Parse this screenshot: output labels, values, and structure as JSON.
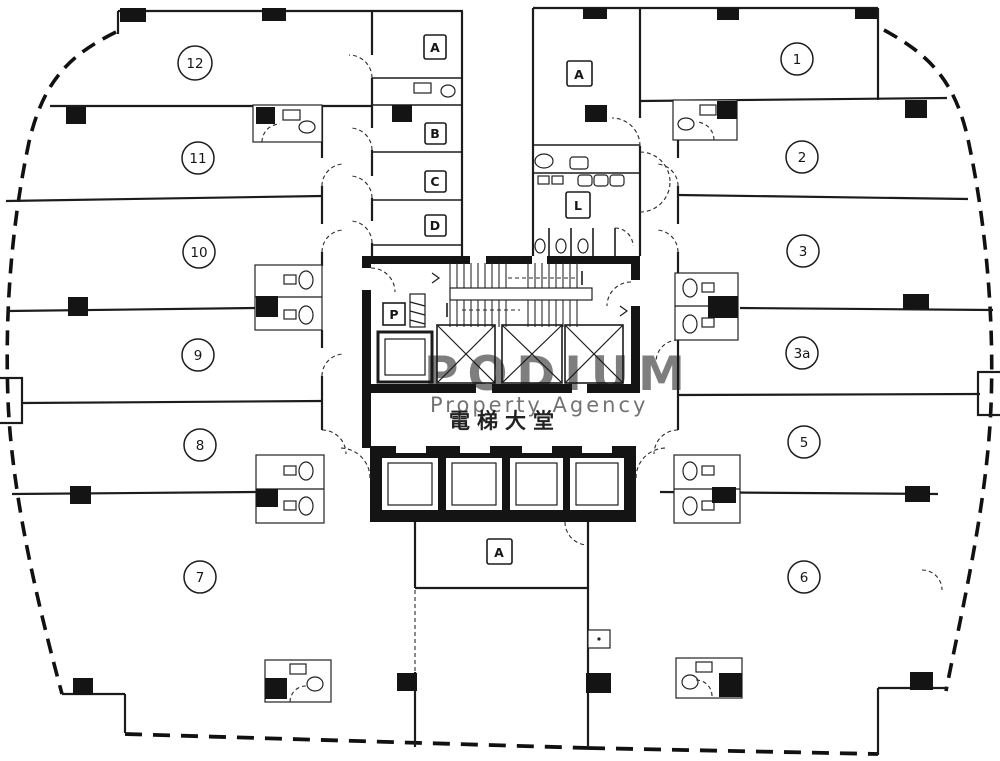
{
  "plan": {
    "lobby_label": "電梯大堂",
    "watermark": {
      "primary": "PODIUM",
      "secondary": "Property Agency"
    },
    "units": [
      {
        "key": "12",
        "label": "12"
      },
      {
        "key": "11",
        "label": "11"
      },
      {
        "key": "10",
        "label": "10"
      },
      {
        "key": "9",
        "label": "9"
      },
      {
        "key": "8",
        "label": "8"
      },
      {
        "key": "7",
        "label": "7"
      },
      {
        "key": "1",
        "label": "1"
      },
      {
        "key": "2",
        "label": "2"
      },
      {
        "key": "3",
        "label": "3"
      },
      {
        "key": "3a",
        "label": "3a"
      },
      {
        "key": "5",
        "label": "5"
      },
      {
        "key": "6",
        "label": "6"
      }
    ],
    "rooms": [
      {
        "key": "a-top-left",
        "label": "A"
      },
      {
        "key": "b",
        "label": "B"
      },
      {
        "key": "c",
        "label": "C"
      },
      {
        "key": "d",
        "label": "D"
      },
      {
        "key": "a-top-right",
        "label": "A"
      },
      {
        "key": "l-lavatory",
        "label": "L"
      },
      {
        "key": "p-pipe-duct",
        "label": "P"
      },
      {
        "key": "a-bottom",
        "label": "A"
      }
    ],
    "colors": {
      "ink": "#1c1c1c",
      "background": "#ffffff",
      "watermark_primary": "#cf8d83",
      "watermark_secondary": "#e9bfb4"
    }
  }
}
